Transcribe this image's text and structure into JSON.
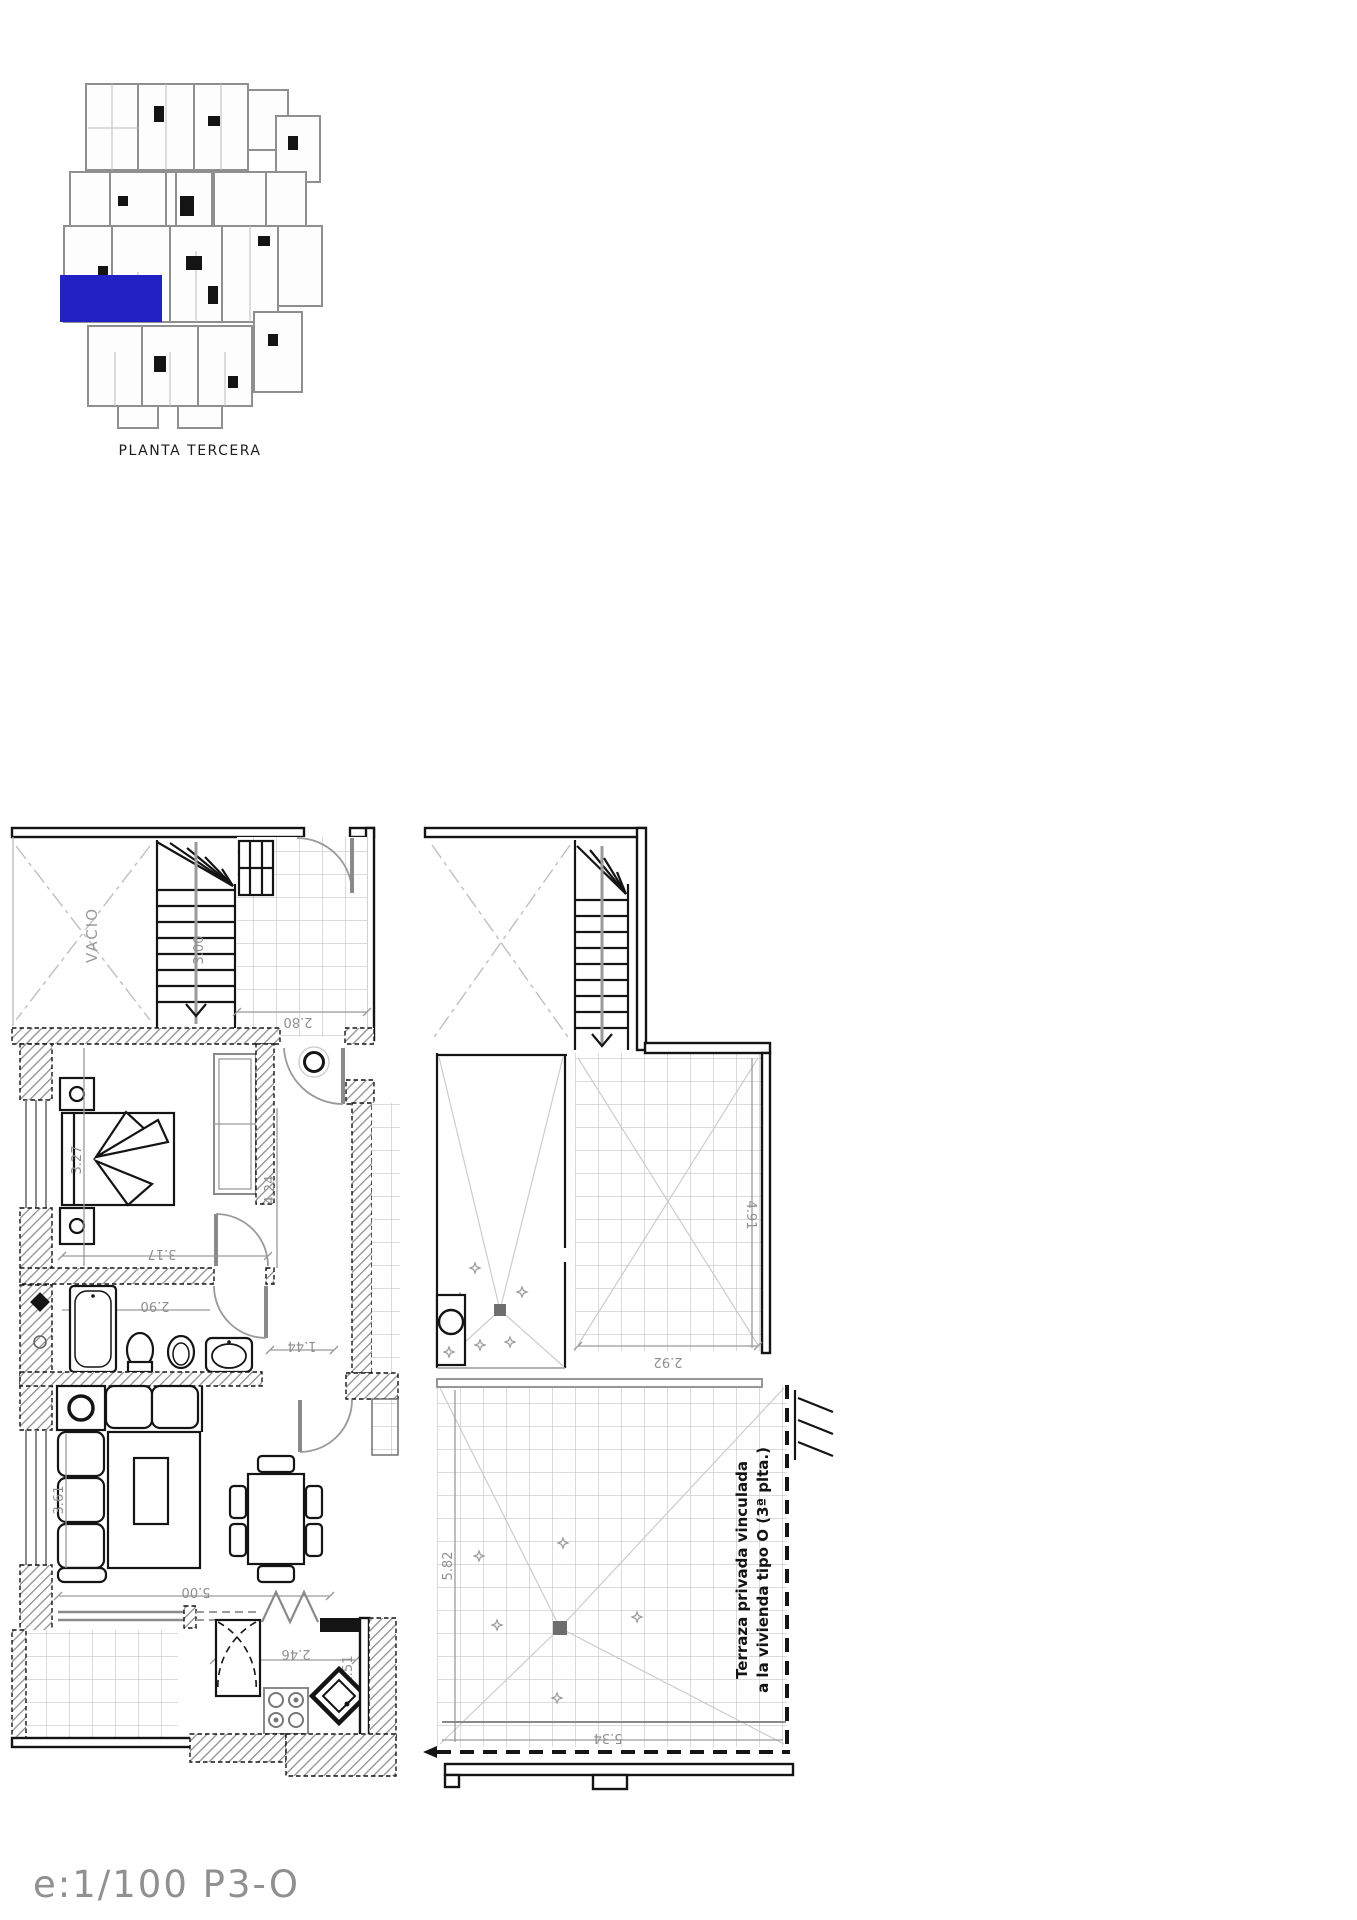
{
  "key_plan": {
    "label": "PLANTA TERCERA",
    "highlight_color": "#2222c4"
  },
  "title_block": {
    "scale_label": "e:1/100  P3-O"
  },
  "floor_plan": {
    "rooms": {
      "void_label": "VACIO"
    },
    "terrace_note": {
      "line1": "Terraza privada vinculada",
      "line2": "a la vivienda tipo O (3ª plta.)"
    },
    "dimensions": {
      "stair_flight": "3.00",
      "upper_landing": "2.80",
      "bedroom_width": "3.27",
      "bedroom_length": "3.17",
      "bathroom_length": "2.90",
      "hallway_width": "1.44",
      "hallway_length": "4.24",
      "living_width": "3.61",
      "living_length": "5.00",
      "kitchen_width": "2.46",
      "kitchen_depth": "1.51",
      "upper_terrace_depth": "4.91",
      "upper_terrace_width": "2.92",
      "main_terrace_depth": "5.82",
      "main_terrace_width": "5.34"
    },
    "colors": {
      "walls": "#141414",
      "dimension_text": "#8f8f8f",
      "tile_lines": "#c6c6c6"
    }
  }
}
